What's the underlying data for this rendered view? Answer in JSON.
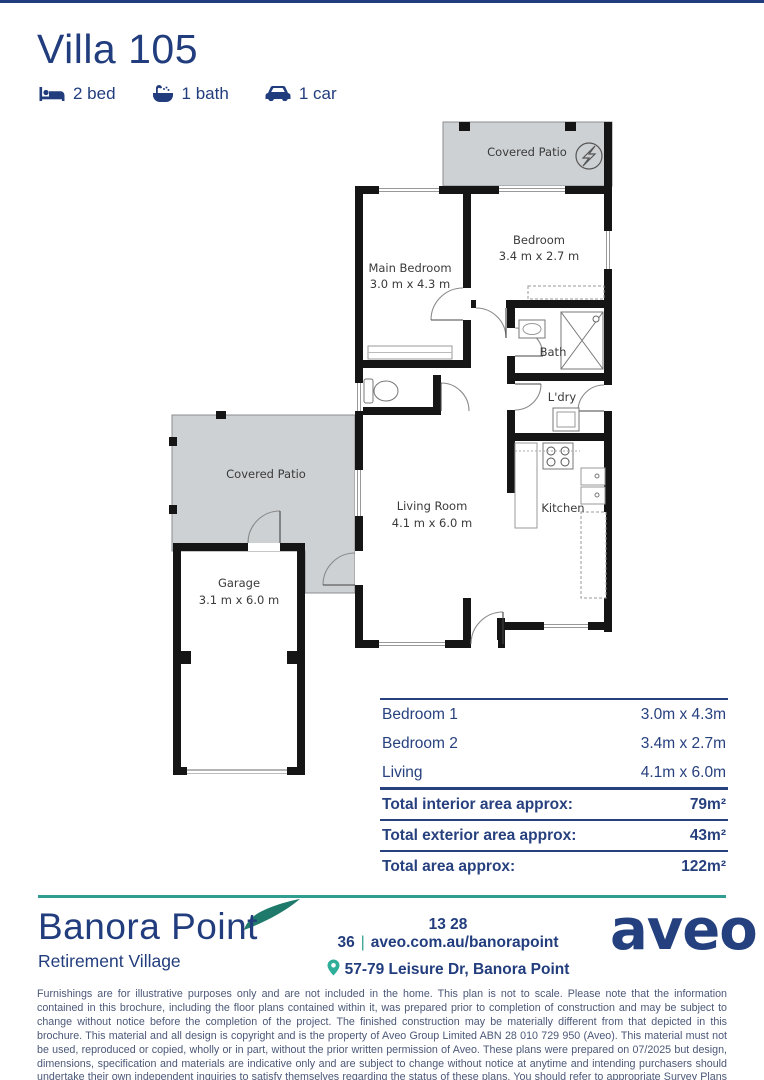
{
  "page": {
    "title": "Villa 105"
  },
  "features": [
    {
      "icon": "bed-icon",
      "label": "2 bed"
    },
    {
      "icon": "bath-icon",
      "label": "1 bath"
    },
    {
      "icon": "car-icon",
      "label": "1 car"
    }
  ],
  "floorplan": {
    "covered_patio_top": "Covered Patio",
    "main_bedroom_name": "Main Bedroom",
    "main_bedroom_dims": "3.0 m x 4.3 m",
    "bedroom2_name": "Bedroom",
    "bedroom2_dims": "3.4 m x 2.7 m",
    "bath": "Bath",
    "laundry": "L'dry",
    "kitchen": "Kitchen",
    "living_name": "Living Room",
    "living_dims": "4.1 m x 6.0 m",
    "covered_patio_left": "Covered Patio",
    "garage_name": "Garage",
    "garage_dims": "3.1 m x 6.0 m"
  },
  "area_table": {
    "rows": [
      {
        "label": "Bedroom 1",
        "value": "3.0m x 4.3m"
      },
      {
        "label": "Bedroom 2",
        "value": "3.4m x 2.7m"
      },
      {
        "label": "Living",
        "value": "4.1m x 6.0m"
      }
    ],
    "totals": [
      {
        "label": "Total interior area approx:",
        "value": "79m²"
      },
      {
        "label": "Total exterior area approx:",
        "value": "43m²"
      },
      {
        "label": "Total area approx:",
        "value": "122m²"
      }
    ]
  },
  "footer": {
    "village_name": "Banora Point",
    "village_subtitle": "Retirement Village",
    "phone": "13 28 36",
    "separator": "|",
    "website": "aveo.com.au/banorapoint",
    "address": "57-79 Leisure Dr, Banora Point",
    "brand": "aveo"
  },
  "disclaimer": "Furnishings are for illustrative purposes only and are not included in the home. This plan is not to scale. Please note that the information contained in this brochure, including the floor plans contained within it, was prepared prior to completion of construction and may be subject to change without notice before the completion of the project. The finished construction may be materially different from that depicted in this brochure. This material and all design is copyright and is the property of Aveo Group Limited ABN 28 010 729 950 (Aveo). This material must not be used, reproduced or copied, wholly or in part, without the prior written permission of Aveo. These plans were prepared on 07/2025 but design, dimensions, specification and materials are indicative only and are subject to change without notice at anytime and intending purchasers should undertake their own independent inquiries to satisfy themselves regarding the status of these plans. You should refer to appropriate Survey Plans for confirmation of individual unit areas.",
  "colors": {
    "navy": "#223d7d",
    "teal": "#2f9d8f",
    "pin_teal": "#2fae9a",
    "patio_gray": "#ced1d4",
    "wall_black": "#151515",
    "disclaimer_slate": "#4b5878"
  }
}
